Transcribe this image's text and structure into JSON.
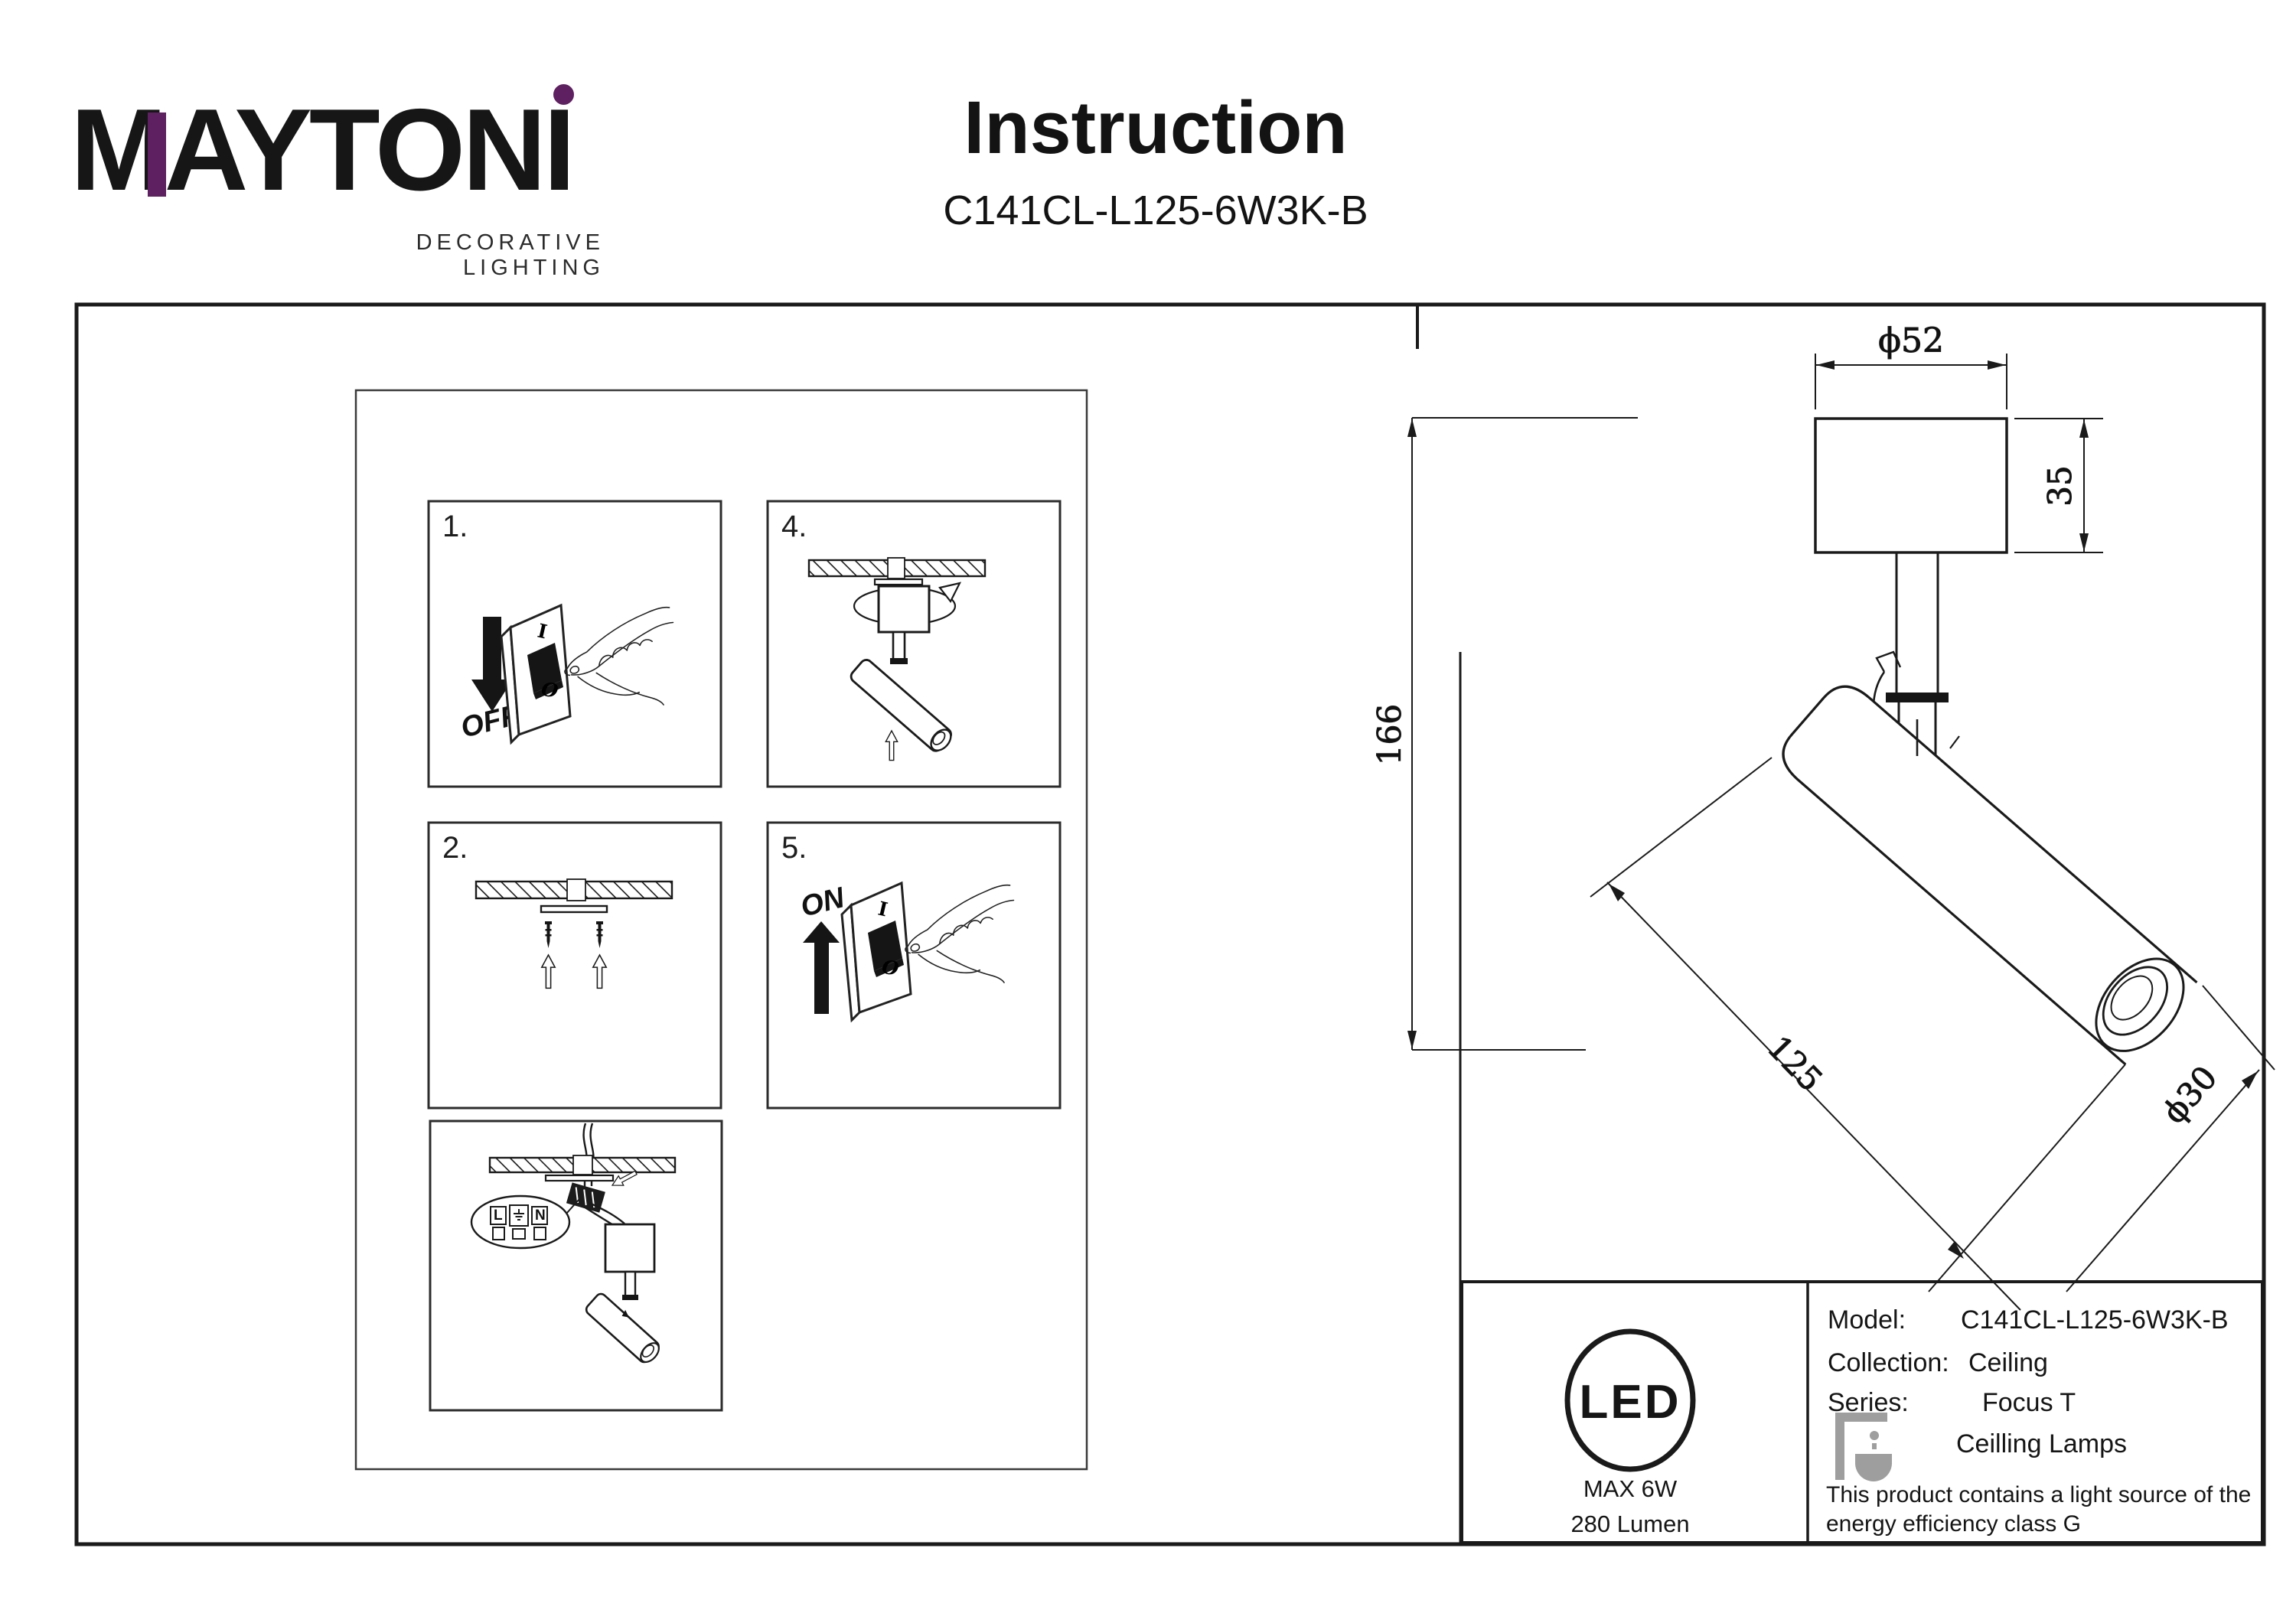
{
  "brand": {
    "name": "MAYTONI",
    "tagline": "DECORATIVE LIGHTING",
    "accent_color": "#5e2060"
  },
  "header": {
    "title": "Instruction",
    "model": "C141CL-L125-6W3K-B"
  },
  "steps": {
    "n1": "1.",
    "n2": "2.",
    "n4": "4.",
    "n5": "5.",
    "off_label": "OFF",
    "on_label": "ON",
    "switch_i": "I",
    "switch_o": "O",
    "terminal_live": "L",
    "terminal_neutral": "N"
  },
  "dimensions": {
    "canopy_diameter": "ϕ52",
    "canopy_height": "35",
    "total_height": "166",
    "body_length": "125",
    "body_diameter": "ϕ30"
  },
  "spec": {
    "led_badge": "LED",
    "max_power": "MAX 6W",
    "luminous_flux": "280 Lumen",
    "model_label": "Model:",
    "model_value": "C141CL-L125-6W3K-B",
    "collection_label": "Collection:",
    "collection_value": "Ceiling",
    "series_label": "Series:",
    "series_value": "Focus T",
    "category": "Ceilling Lamps",
    "note_line1": "This product contains a light source of the",
    "note_line2": "energy efficiency class G"
  }
}
